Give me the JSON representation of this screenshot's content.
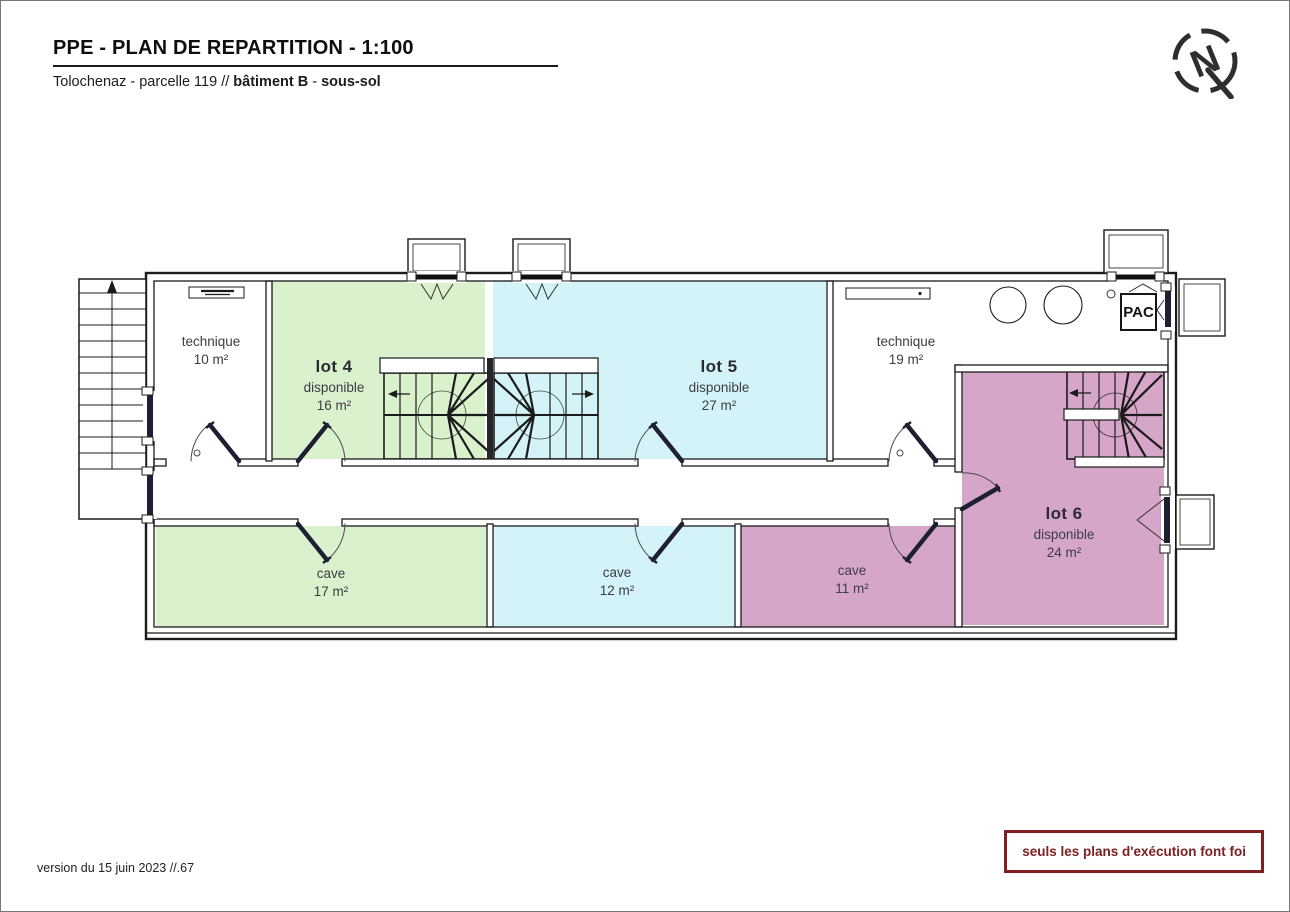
{
  "header": {
    "title": "PPE - PLAN DE REPARTITION - 1:100",
    "subtitle": {
      "prefix": "Tolochenaz - parcelle 119 // ",
      "building": "bâtiment B",
      "separator": " - ",
      "floor": "sous-sol"
    }
  },
  "north_indicator": {
    "letter": "N"
  },
  "plan": {
    "rooms": [
      {
        "name": "technique-10",
        "label": "technique",
        "area": "10 m²",
        "fill": "#ffffff"
      },
      {
        "name": "lot-4",
        "title": "lot 4",
        "status": "disponible",
        "area": "16 m²",
        "fill": "#d9f1cd"
      },
      {
        "name": "lot-5",
        "title": "lot 5",
        "status": "disponible",
        "area": "27 m²",
        "fill": "#d4f3f9"
      },
      {
        "name": "technique-19",
        "label": "technique",
        "area": "19 m²",
        "fill": "#ffffff"
      },
      {
        "name": "lot-6",
        "title": "lot 6",
        "status": "disponible",
        "area": "24 m²",
        "fill": "#d6a6c9"
      },
      {
        "name": "cave-17",
        "label": "cave",
        "area": "17 m²",
        "fill": "#d9f1cd"
      },
      {
        "name": "cave-12",
        "label": "cave",
        "area": "12 m²",
        "fill": "#d4f3f9"
      },
      {
        "name": "cave-11",
        "label": "cave",
        "area": "11 m²",
        "fill": "#d6a6c9"
      }
    ],
    "equipment": {
      "heat_pump": "PAC"
    }
  },
  "footer": {
    "version": "version du 15 juin 2023 //.67",
    "disclaimer": "seuls les plans d'exécution font foi"
  },
  "colors": {
    "green": "#d9f1cd",
    "cyan": "#d4f3f9",
    "pink": "#d6a6c9",
    "disclaimer_red": "#7c2020",
    "line": "#1b1b1b"
  }
}
